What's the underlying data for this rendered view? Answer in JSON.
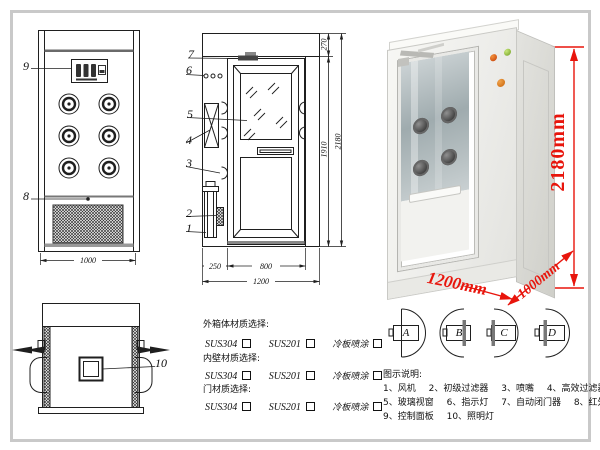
{
  "colors": {
    "annotation_red": "#e8150c",
    "line": "#1f1f1f"
  },
  "front_view": {
    "callouts": [
      "9",
      "8"
    ],
    "width_dim": "1000"
  },
  "section_view": {
    "callouts": [
      "7",
      "6",
      "5",
      "4",
      "3",
      "2",
      "1"
    ],
    "dims": {
      "left_w": "250",
      "door_w": "800",
      "total_w": "1200",
      "header_h": "270",
      "door_h": "1910",
      "total_h": "2180"
    }
  },
  "top_view": {
    "callout": "10"
  },
  "photo": {
    "height_label": "2180mm",
    "width_label": "1200mm",
    "depth_label": "1000mm"
  },
  "materials": {
    "sections": [
      {
        "title": "外箱体材质选择:",
        "options": [
          "SUS304",
          "SUS201",
          "冷板喷涂"
        ]
      },
      {
        "title": "内壁材质选择:",
        "options": [
          "SUS304",
          "SUS201",
          "冷板喷涂"
        ]
      },
      {
        "title": "门材质选择:",
        "options": [
          "SUS304",
          "SUS201",
          "冷板喷涂"
        ]
      }
    ]
  },
  "door_configs": {
    "labels": [
      "A",
      "B",
      "C",
      "D"
    ]
  },
  "legend": {
    "title": "图示说明:",
    "items": [
      "1、风机",
      "2、初级过滤器",
      "3、喷嘴",
      "4、高效过滤器",
      "5、玻璃视窗",
      "6、指示灯",
      "7、自动闭门器",
      "8、红外线感应器",
      "9、控制面板",
      "10、照明灯"
    ]
  }
}
